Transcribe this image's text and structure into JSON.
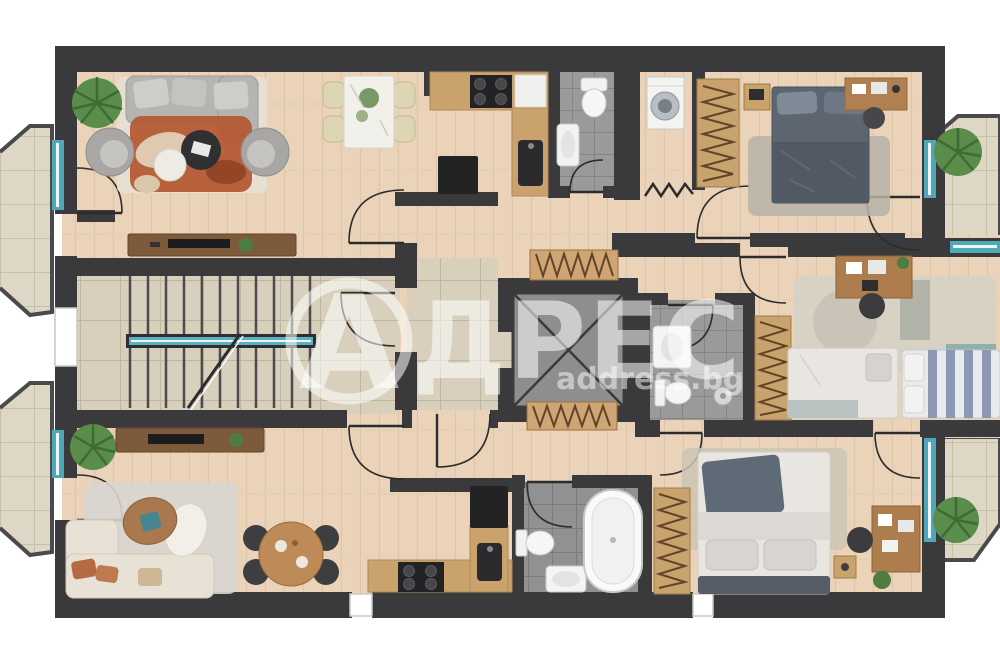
{
  "watermark": {
    "logo_letter": "А",
    "brand": "АДРЕС",
    "brand_after_logo": "ДРЕС",
    "url": "address.bg"
  },
  "palette": {
    "wall": "#3a3a3d",
    "wood_floor": "#ead3b8",
    "stone_floor": "#d8d0bd",
    "balcony_floor": "#ded7c5",
    "bath_tile": "#9a9a98",
    "bath_tile_dark": "#8f9192",
    "window_teal": "#4fa8b8",
    "furniture_wood": "#c9a26e",
    "furniture_wood_dark": "#7d5a3a",
    "accent_terracotta": "#b65a33",
    "watermark_color": "rgba(255,255,255,0.55)"
  },
  "rooms": [
    {
      "name": "living-dining-kitchen-top",
      "furniture": [
        "sofa",
        "armchairs",
        "terracotta-rug",
        "coffee-tables",
        "dining-table",
        "sideboard-tv",
        "kitchen-counter",
        "stove",
        "sink",
        "fridge",
        "plant"
      ]
    },
    {
      "name": "wc-top",
      "furniture": [
        "toilet",
        "sink"
      ]
    },
    {
      "name": "laundry",
      "furniture": [
        "washing-machine"
      ]
    },
    {
      "name": "bedroom-top",
      "furniture": [
        "double-bed",
        "nightstands",
        "wardrobe",
        "desk",
        "chair",
        "rug"
      ]
    },
    {
      "name": "stairwell",
      "furniture": [
        "stairs",
        "railing"
      ]
    },
    {
      "name": "corridor",
      "furniture": [
        "radiator-top",
        "radiator-bottom"
      ]
    },
    {
      "name": "elevator",
      "furniture": [
        "elevator-shaft"
      ]
    },
    {
      "name": "kids-bedroom",
      "furniture": [
        "single-bed-1",
        "single-bed-2",
        "desk",
        "chair",
        "wardrobe",
        "rug"
      ]
    },
    {
      "name": "bathroom-middle",
      "furniture": [
        "shower",
        "toilet",
        "sink"
      ]
    },
    {
      "name": "living-dining-kitchen-bottom",
      "furniture": [
        "corner-sofa",
        "coffee-table",
        "rug",
        "round-dining-table",
        "sideboard-tv",
        "kitchen-counter",
        "stove",
        "sink",
        "fridge",
        "plant"
      ]
    },
    {
      "name": "bathroom-bottom",
      "furniture": [
        "bathtub",
        "toilet",
        "sink"
      ]
    },
    {
      "name": "bedroom-bottom",
      "furniture": [
        "double-bed",
        "wardrobe",
        "desk",
        "chair",
        "nightstand",
        "rug"
      ]
    },
    {
      "name": "balcony-top-left",
      "furniture": []
    },
    {
      "name": "balcony-bottom-left",
      "furniture": []
    },
    {
      "name": "balcony-top-right",
      "furniture": [
        "plant"
      ]
    },
    {
      "name": "balcony-bottom-right",
      "furniture": [
        "plant"
      ]
    }
  ]
}
